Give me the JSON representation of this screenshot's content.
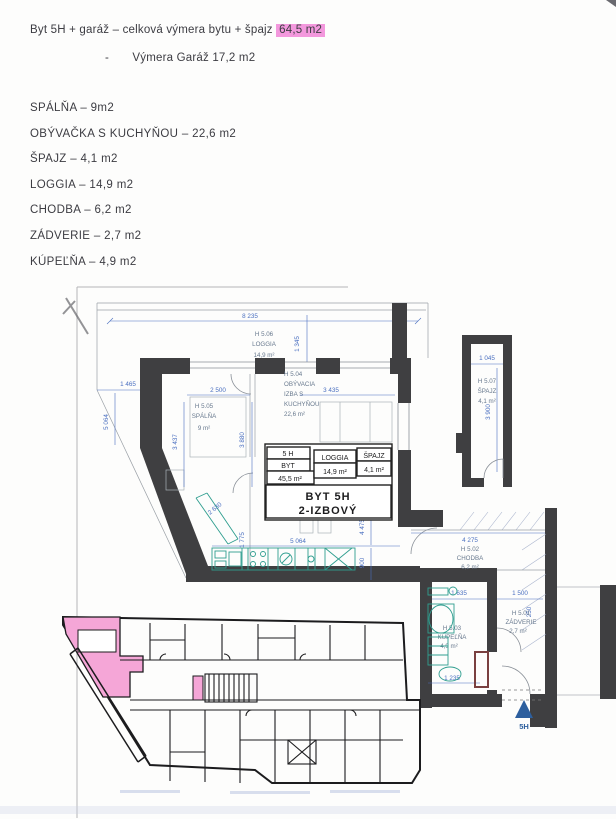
{
  "page": {
    "header": {
      "line1_prefix": "Byt 5H + garáž – celková výmera bytu + špajz",
      "line1_highlight": "64,5 m2",
      "line2_bullet": "-",
      "line2_text": "Výmera Garáž 17,2 m2"
    },
    "room_list": [
      "SPÁLŇA – 9m2",
      "OBÝVAČKA S KUCHYŇOU – 22,6 m2",
      "ŠPAJZ – 4,1 m2",
      "LOGGIA – 14,9 m2",
      "CHODBA – 6,2 m2",
      "ZÁDVERIE – 2,7 m2",
      "KÚPEĽŇA – 4,9 m2"
    ]
  },
  "floor_plan": {
    "rooms": {
      "loggia": {
        "code": "H 5.06",
        "name": "LOGGIA",
        "area": "14,9 m²"
      },
      "spalna": {
        "code": "H 5.05",
        "name": "SPÁLŇA",
        "area": "9 m²"
      },
      "obyvacka": {
        "code": "H 5.04",
        "line1": "OBÝVACIA",
        "line2": "IZBA S",
        "line3": "KUCHYŇOU",
        "area": "22,6 m²"
      },
      "spajz": {
        "code": "H 5.07",
        "name": "ŠPAJZ",
        "area": "4,1 m²"
      },
      "chodba": {
        "code": "H 5.02",
        "name": "CHODBA",
        "area": "6,2 m²"
      },
      "zadverie": {
        "code": "H 5.01",
        "name": "ZÁDVERIE",
        "area": "2,7 m²"
      },
      "kupelna": {
        "code": "H 5.03",
        "name": "KÚPEĽŇA",
        "area": "4,9 m²"
      }
    },
    "dims": {
      "d8235": "8 235",
      "d1345": "1 345",
      "d1465": "1 465",
      "d5064L": "5 064",
      "d2500": "2 500",
      "d3437": "3 437",
      "d3880": "3 880",
      "d3435": "3 435",
      "d1045": "1 045",
      "d3900": "3 900",
      "d2630": "2 630",
      "d1775": "1 775",
      "d5064K": "5 064",
      "d900": "900",
      "d4475": "4 475",
      "d4275": "4 275",
      "d1635": "1 635",
      "d1500": "1 500",
      "d250": "250",
      "d1235": "1 235"
    },
    "info_table": {
      "col1_row1": "5 H",
      "col1_row2": "BYT",
      "col1_row3": "45,5 m²",
      "loggia_label": "LOGGIA",
      "loggia_value": "14,9 m²",
      "spajz_label": "ŠPAJZ",
      "spajz_value": "4,1 m²",
      "title_line1": "BYT 5H",
      "title_line2": "2-IZBOVÝ"
    },
    "entrance_label": "5H"
  },
  "colors": {
    "highlight_pink": "#f398dd",
    "overview_unit_pink": "#f5a6d7",
    "dimension_blue": "#4a6fc0",
    "fixture_teal": "#2f9e8f",
    "wall_dark": "#3f3f41",
    "entrance_blue": "#2d5f9e",
    "door_frame_maroon": "#7a4040"
  }
}
